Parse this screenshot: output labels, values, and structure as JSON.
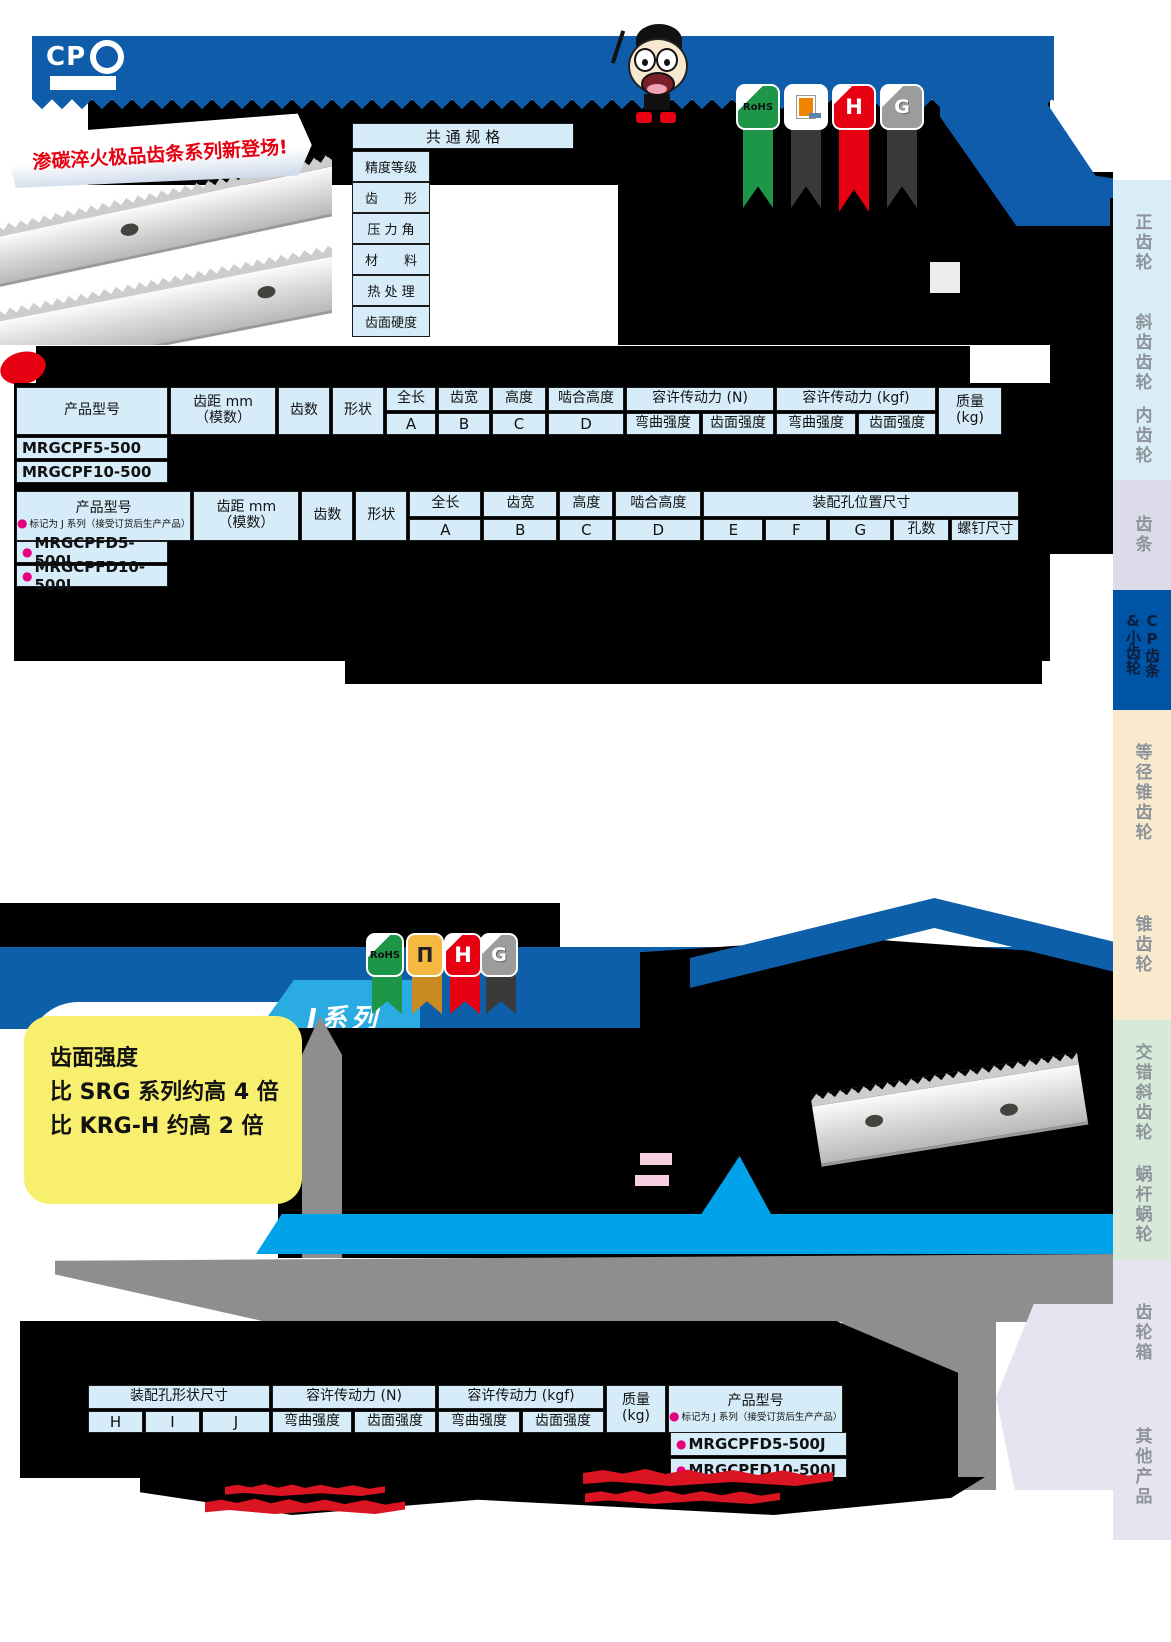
{
  "header": {
    "cp_logo": "CP",
    "new_banner": "渗碳淬火极品齿条系列新登场!",
    "badges": {
      "rohs": "RoHS",
      "h": "H",
      "g": "G",
      "rack_symbol": "Π"
    }
  },
  "common_spec": {
    "title": "共 通 规 格",
    "rows": [
      "精度等级",
      "齿　　形",
      "压 力 角",
      "材　　料",
      "热 处 理",
      "齿面硬度"
    ]
  },
  "labels": {
    "bullet": "●",
    "product_no": "产品型号",
    "pitch1": "齿距 mm",
    "pitch2": "（模数）",
    "teeth": "齿数",
    "shape": "形状",
    "total_length": "全长",
    "face_width": "齿宽",
    "height": "高度",
    "mesh_height": "啮合高度",
    "A": "A",
    "B": "B",
    "C": "C",
    "D": "D",
    "E": "E",
    "F": "F",
    "G": "G",
    "H": "H",
    "I": "I",
    "J": "J",
    "hole_count": "孔数",
    "screw_size": "螺钉尺寸",
    "mount_pos": "装配孔位置尺寸",
    "mount_shape": "装配孔形状尺寸",
    "force_n": "容许传动力 (N)",
    "force_kgf": "容许传动力 (kgf)",
    "bend": "弯曲强度",
    "surface": "齿面强度",
    "mass": "质量",
    "mass_unit": "(kg)",
    "j_note": "标记为 J 系列（接受订货后生产产品）"
  },
  "table1": {
    "products": [
      "MRGCPF5-500",
      "MRGCPF10-500"
    ]
  },
  "table2": {
    "products": [
      "MRGCPFD5-500J",
      "MRGCPFD10-500J"
    ]
  },
  "table3": {
    "products": [
      "MRGCPFD5-500J",
      "MRGCPFD10-500J"
    ]
  },
  "section2": {
    "series_tab": "J系列",
    "strength_line1": "齿面强度",
    "strength_line2": "比 SRG 系列约高 4 倍",
    "strength_line3": "比 KRG-H 约高 2 倍"
  },
  "sidebar": {
    "items": [
      "正齿轮",
      "斜齿齿轮",
      "内齿轮",
      "齿条",
      "CP齿条&小齿轮",
      "等径锥齿轮",
      "锥齿轮",
      "交错斜齿轮",
      "蜗杆蜗轮",
      "齿轮箱",
      "其他产品"
    ]
  },
  "colors": {
    "brand_blue": "#0f5cab",
    "cyan": "#00a2e9",
    "table_cell_blue": "#d6edf9",
    "active_tab_blue": "#0054a5",
    "accent_red": "#e60012",
    "magenta_bullet": "#e4007f",
    "highlight_yellow": "#f8ef6e"
  }
}
